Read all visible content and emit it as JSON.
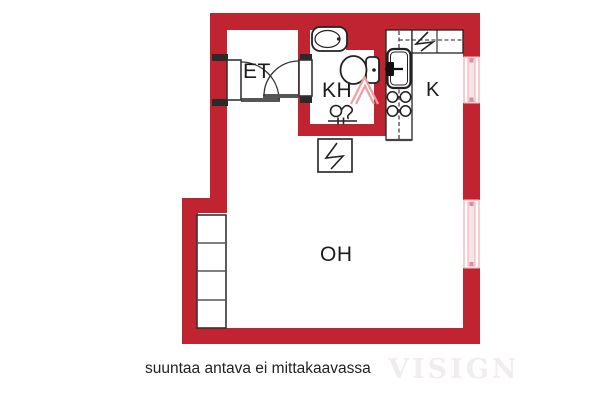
{
  "title": "apartment-floor-plan",
  "rooms": {
    "et": "ET",
    "kh": "KH",
    "k": "K",
    "oh": "OH"
  },
  "caption": "suuntaa antava ei mittakaavassa",
  "watermark": "VISIGN",
  "colors": {
    "wall": "#bf2430",
    "window_frame": "#f0aab1",
    "window_glass": "#f9e3e6",
    "window_tick": "#d98c95",
    "fixture_line": "#222222",
    "shower": "#ef9ea6",
    "threshold": "#555555",
    "label_text": "#1b1b1b",
    "caption_text": "#222222",
    "watermark_text": "#f0edec"
  },
  "fixtures": [
    "entry-door",
    "bathroom-door",
    "washbasin",
    "toilet",
    "shower",
    "floor-drain",
    "washing-machine",
    "kitchen-sink",
    "stove",
    "fridge",
    "upper-cabinets",
    "wardrobe",
    "window-kitchen",
    "window-living-room"
  ]
}
